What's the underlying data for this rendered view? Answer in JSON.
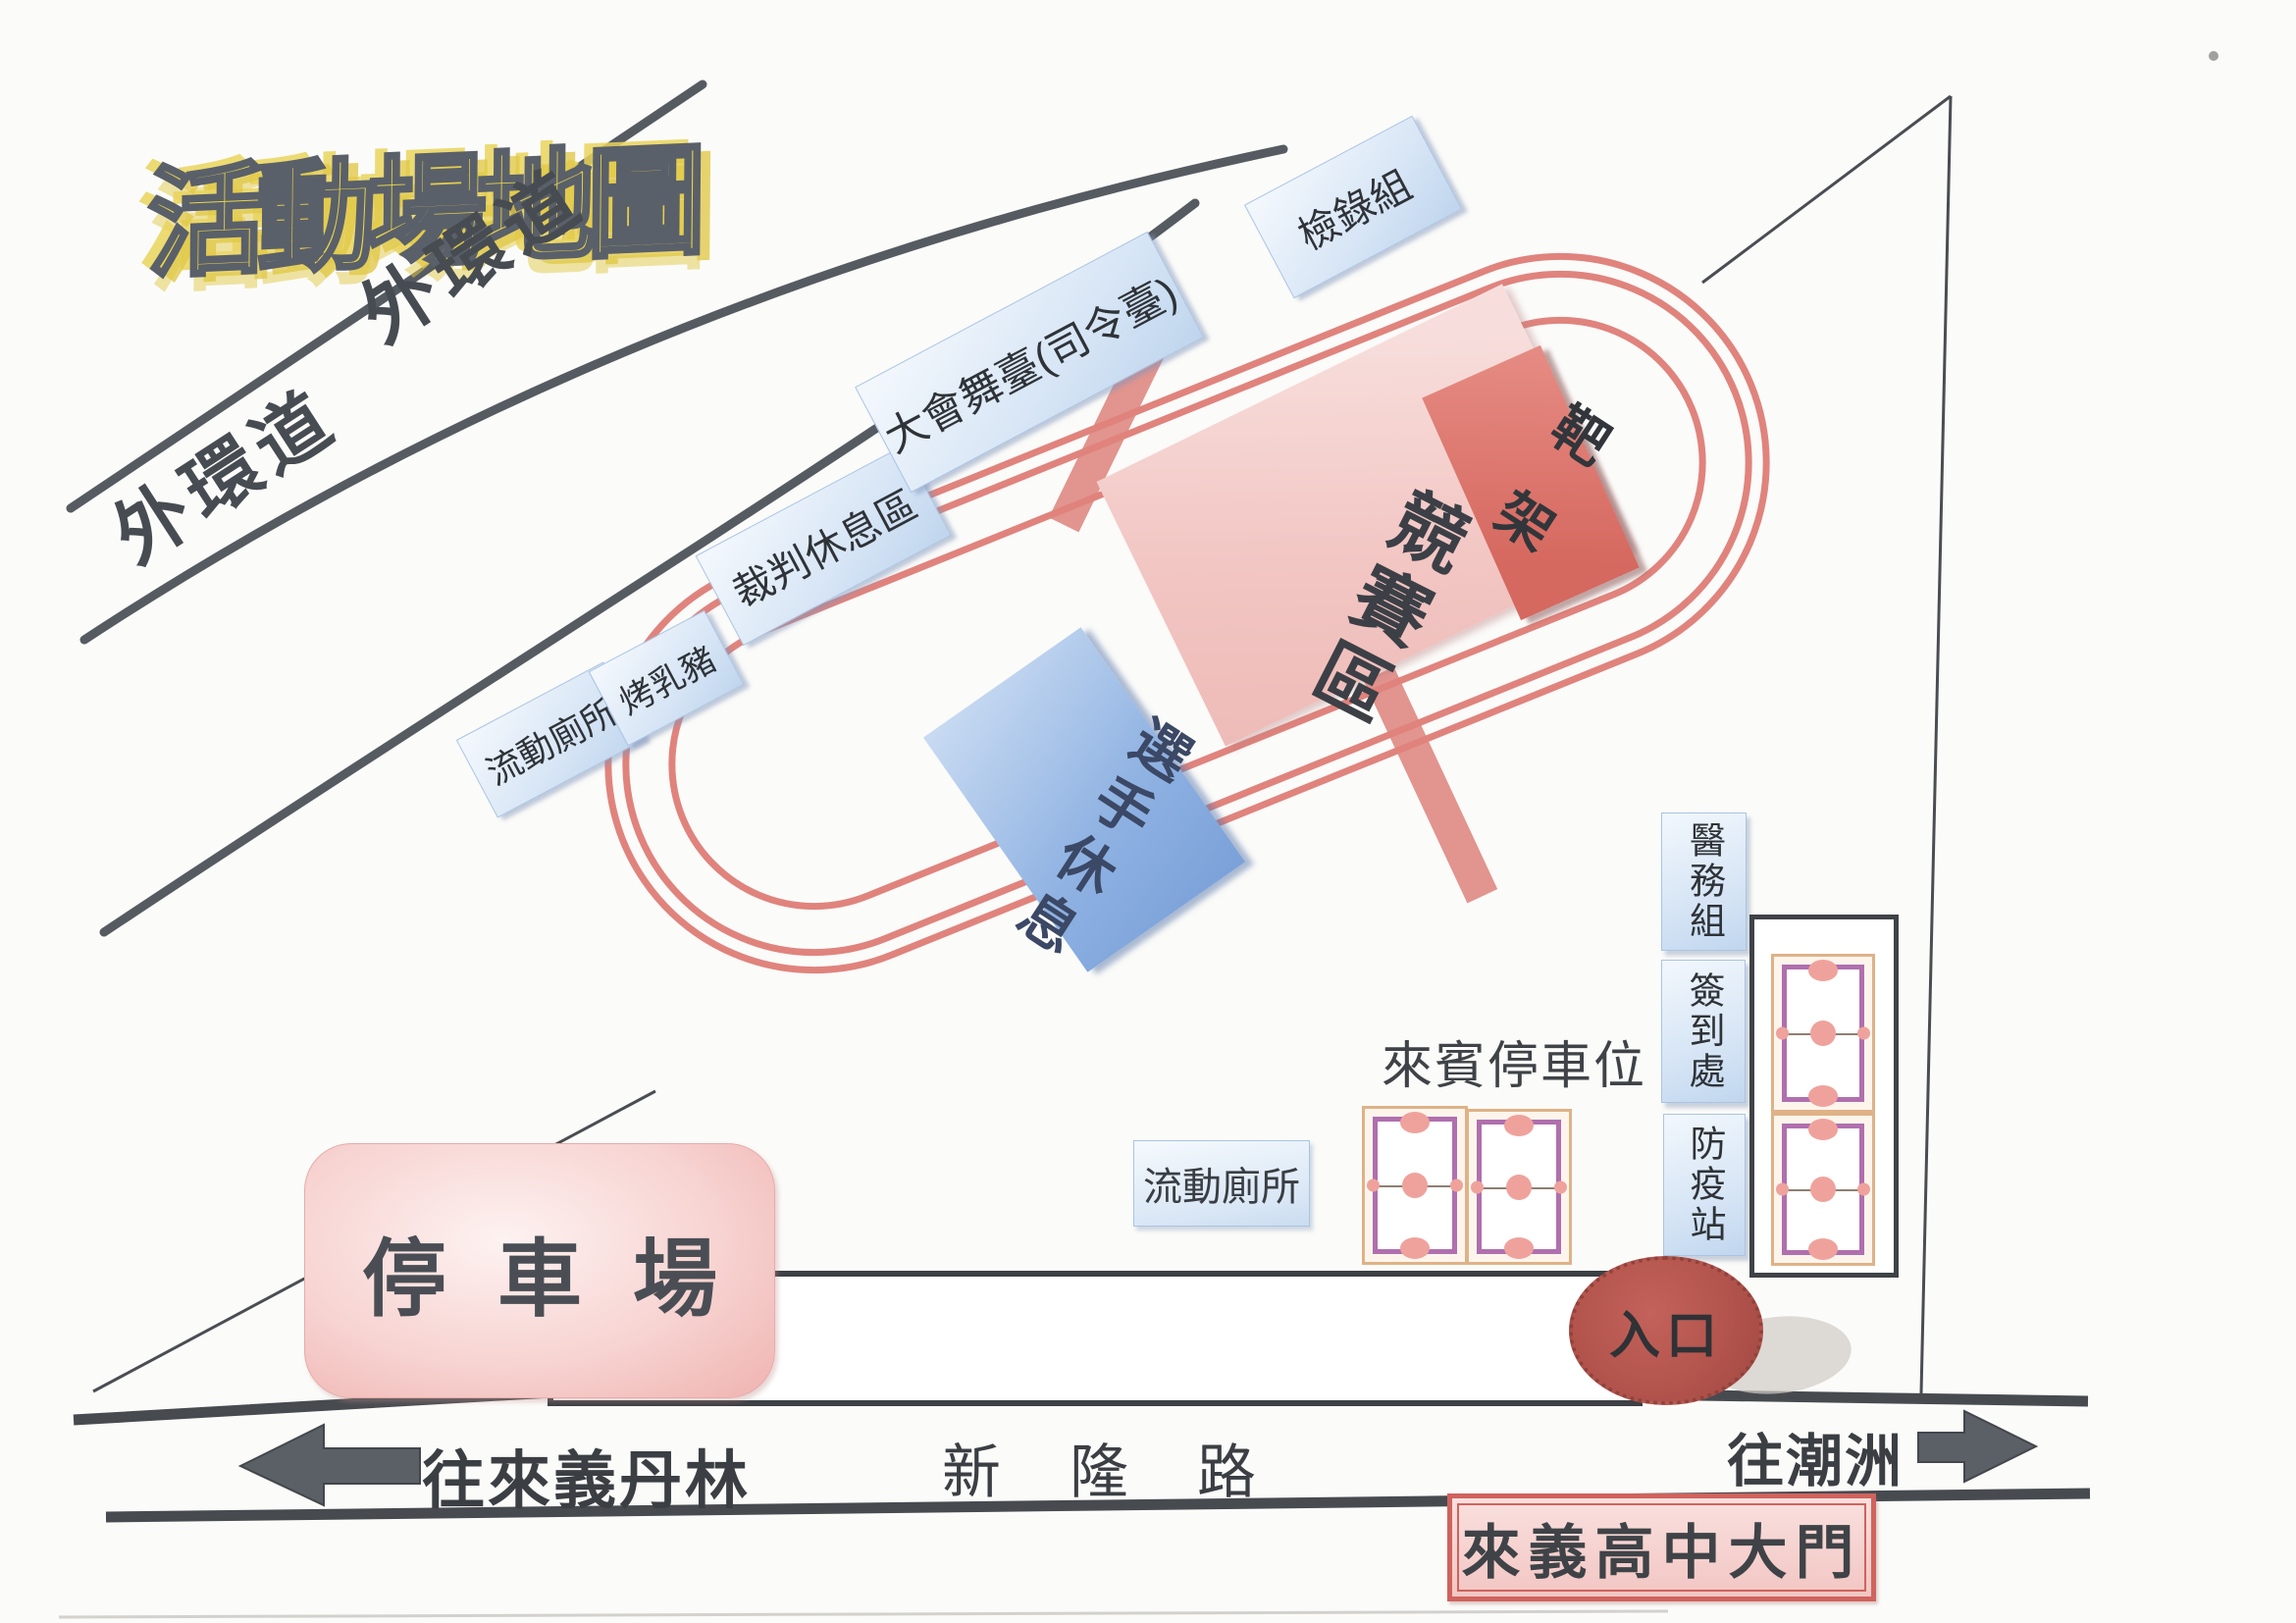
{
  "title": "活動場地圖",
  "ring_road": {
    "label_upper": "外環道",
    "label_lower": "外環道"
  },
  "roadside": {
    "mobile_toilet": "流動廁所",
    "roast_pig": "烤乳豬",
    "referee_rest": "裁判休息區",
    "main_stage": "大會舞臺(司令臺)",
    "check_in": "檢錄組"
  },
  "infield": {
    "competition_zone": "競賽區",
    "target_rack": "靶架",
    "athlete_rest": "選手休息"
  },
  "stations": {
    "medical": "醫務組",
    "sign_in": "簽到處",
    "epidemic_prevention": "防疫站"
  },
  "parking": {
    "guest_label": "來賓停車位",
    "parking_lot": "停車場",
    "mobile_toilet": "流動廁所"
  },
  "entrance": {
    "label": "入口"
  },
  "main_road": {
    "to_left": "往來義丹林",
    "name": "新隆路",
    "to_right": "往潮洲",
    "school_gate": "來義高中大門"
  },
  "colors": {
    "track": "#e0837d",
    "box_blue": "#d9e8f7",
    "zone_pink": "#f3cdca",
    "target_red": "#d96b62",
    "entrance_red": "#b3544d",
    "title_yellow": "#ead54e"
  }
}
